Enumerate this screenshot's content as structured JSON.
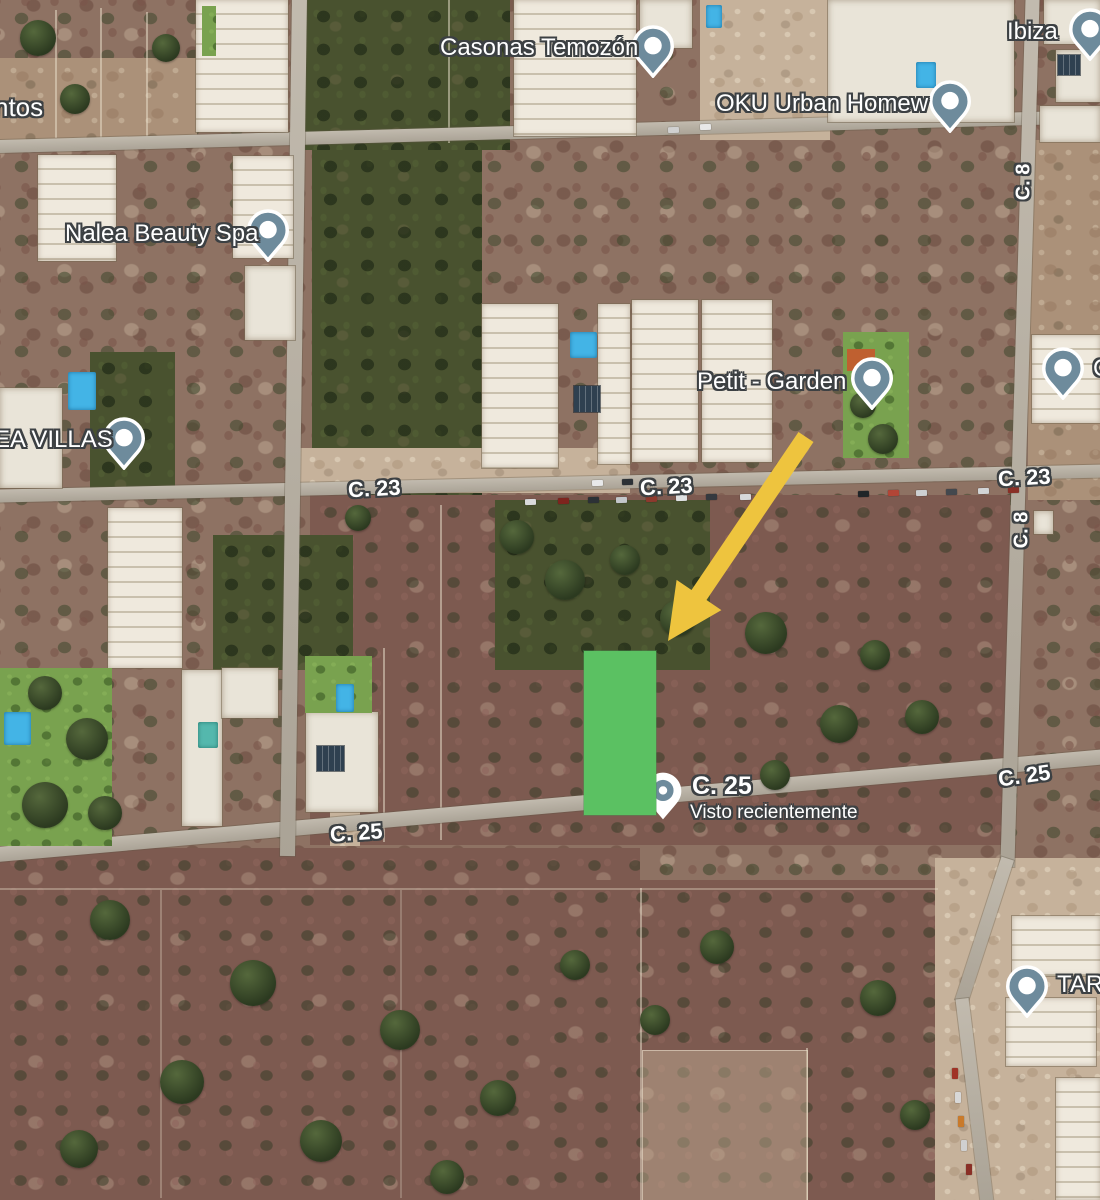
{
  "map": {
    "view": "satellite",
    "pins": {
      "casonas_temozon": {
        "label": "Casonas Temozón"
      },
      "oku_urban_homew": {
        "label": "OKU Urban Homew"
      },
      "ibiza": {
        "label": "Ibiza"
      },
      "nalea_beauty_spa": {
        "label": "Nalea Beauty Spa"
      },
      "ea_villas": {
        "label": "EA VILLAS"
      },
      "petit_garden": {
        "label": "Petit - Garden"
      },
      "right_edge": {
        "label": "C"
      },
      "tare": {
        "label": "TARE"
      }
    },
    "recent": {
      "street": "C. 25",
      "note": "Visto recientemente"
    },
    "streets": {
      "c23": "C. 23",
      "c8": "C. 8",
      "c25": "C. 25"
    },
    "partial_left_label": "ntos",
    "highlight_color": "#5bc162",
    "arrow_color": "#eec43e",
    "pin_color": "#6e8b9c"
  }
}
